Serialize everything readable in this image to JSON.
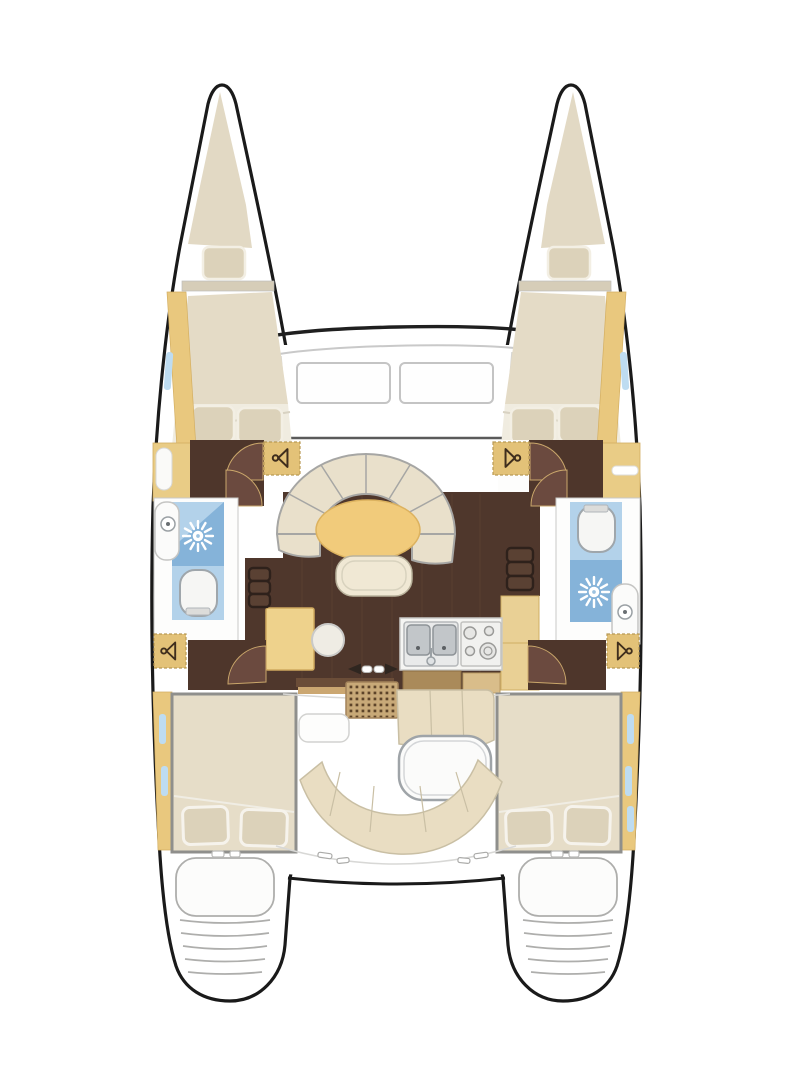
{
  "diagram": {
    "title": "Catamaran interior layout floor plan, bow up",
    "type": "boat-floorplan",
    "orientation": "bow-up",
    "hulls": [
      "port",
      "starboard"
    ],
    "areas": [
      {
        "id": "port-forepeak",
        "label": "Port forepeak berth with pillow"
      },
      {
        "id": "port-forward-cabin",
        "label": "Port forward double cabin with two pillows"
      },
      {
        "id": "port-head",
        "label": "Port head with sink, shower and toilet"
      },
      {
        "id": "port-aft-cabin",
        "label": "Port aft double cabin with two pillows"
      },
      {
        "id": "starboard-forepeak",
        "label": "Starboard forepeak berth with pillow"
      },
      {
        "id": "starboard-forward-cabin",
        "label": "Starboard forward double cabin with two pillows"
      },
      {
        "id": "starboard-head",
        "label": "Starboard head with toilet, shower and sink"
      },
      {
        "id": "starboard-aft-cabin",
        "label": "Starboard aft double cabin with two pillows"
      },
      {
        "id": "saloon",
        "label": "Saloon with curved settee, oval table and ottoman"
      },
      {
        "id": "galley",
        "label": "Galley with double sink and four-burner stove"
      },
      {
        "id": "nav-station",
        "label": "Chart table with round stool"
      },
      {
        "id": "cockpit",
        "label": "Aft cockpit with grating, table and curved bench"
      },
      {
        "id": "transoms",
        "label": "Twin transom swim steps"
      }
    ],
    "icons": [
      "hanger-icon",
      "shower-drain-icon",
      "toilet-icon",
      "sink-faucet-icon",
      "stove-burners-icon",
      "sliding-door-arrows-icon",
      "companionway-steps-icon"
    ],
    "colors": {
      "hull_outline": "#1a1a1a",
      "upholstery_cream": "#e5dcc7",
      "pillow_cream": "#dcd2ba",
      "wood_trim_tan": "#e9c87e",
      "table_gold": "#f1cb7b",
      "floor_dark_wood": "#4f372c",
      "door_swing_brown": "#6b4a3f",
      "shower_blue": "#85b3d9",
      "wet_room_blue": "#b3d2ea",
      "window_blue": "#bedcf1",
      "counter_white": "#f5f5f3",
      "grating_tan": "#c8a978"
    }
  }
}
